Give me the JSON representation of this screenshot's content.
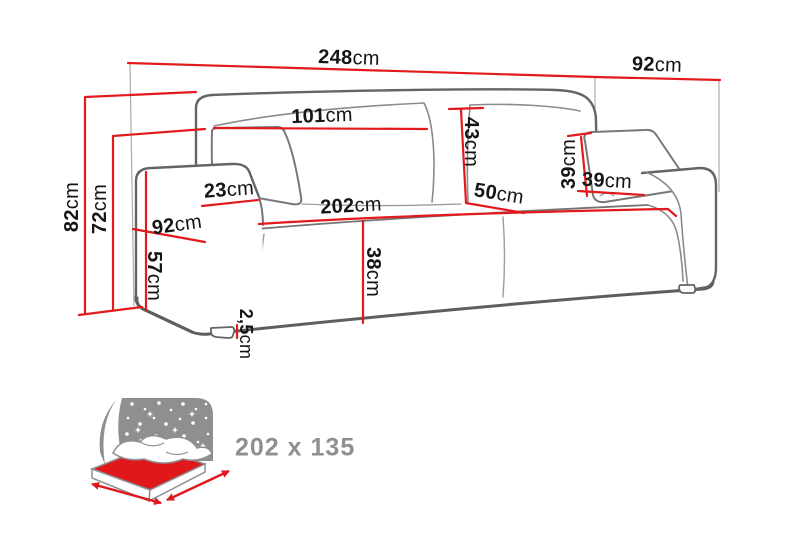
{
  "diagram": {
    "kind": "sofa dimension drawing",
    "unit_system": "metric"
  },
  "dimensions": {
    "total_width": {
      "value": "248",
      "unit": "cm"
    },
    "total_depth": {
      "value": "92",
      "unit": "cm"
    },
    "back_cushion_width": {
      "value": "101",
      "unit": "cm"
    },
    "back_cushion_height": {
      "value": "43",
      "unit": "cm"
    },
    "armrest_top_width": {
      "value": "23",
      "unit": "cm"
    },
    "seat_depth": {
      "value": "50",
      "unit": "cm"
    },
    "pillow_height": {
      "value": "39",
      "unit": "cm"
    },
    "pillow_width": {
      "value": "39",
      "unit": "cm"
    },
    "arm_side_depth": {
      "value": "92",
      "unit": "cm"
    },
    "seat_width": {
      "value": "202",
      "unit": "cm"
    },
    "total_height": {
      "value": "82",
      "unit": "cm"
    },
    "back_height": {
      "value": "72",
      "unit": "cm"
    },
    "armrest_height": {
      "value": "57",
      "unit": "cm"
    },
    "seat_height": {
      "value": "38",
      "unit": "cm"
    },
    "leg_height": {
      "value": "2,5",
      "unit": "cm"
    }
  },
  "sleeping_area": {
    "size_label": "202 x 135",
    "icon": "bed-sleeping-area-icon"
  },
  "colors": {
    "dimension_line_red": "#e2191d",
    "outline_gray": "#636466",
    "light_line_gray": "#9c9da0",
    "icon_gray": "#8d8f91",
    "mattress_red": "#e0181c",
    "background": "#ffffff"
  }
}
